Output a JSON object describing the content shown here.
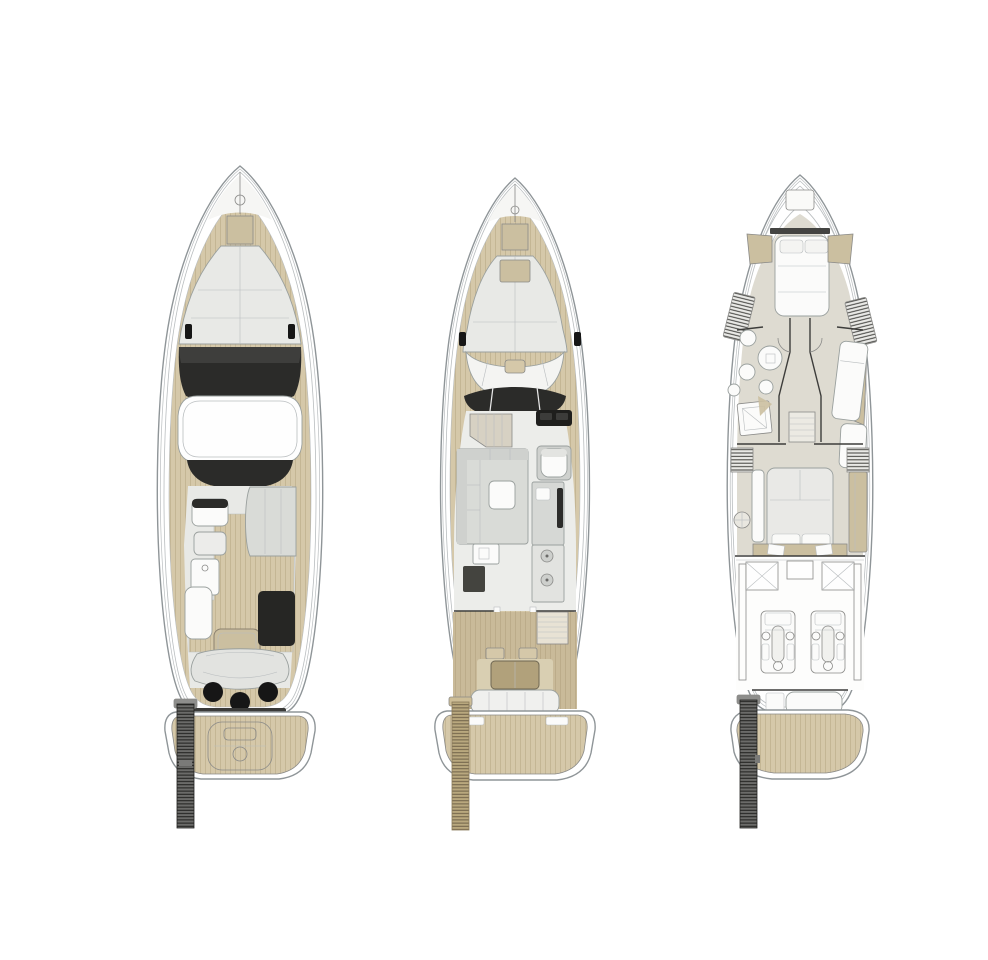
{
  "figure": {
    "type": "yacht-deck-plan-drawing",
    "views": 3
  },
  "colors": {
    "background": "#ffffff",
    "hull_white": "#ffffff",
    "hull_outline": "#8f9598",
    "hull_inner_line": "#b9bdbf",
    "teak": "#d5c8a9",
    "teak_dark": "#c9ba99",
    "plank_line": "#a4936f",
    "deck_gray": "#e8e9e6",
    "room_floor": "#dedbd1",
    "furniture_gray": "#d9dbd7",
    "furniture_gray2": "#cfd1ce",
    "furniture_edge": "#9aa09e",
    "white_fixture": "#fbfbfa",
    "beige": "#d7d1c3",
    "tan_accent": "#cbbfa0",
    "table_tan": "#b1a17b",
    "dark_glass": "#2b2b29",
    "dark_glass_light": "#4f4f4c",
    "black": "#161616",
    "wall_dark": "#3d3d3b",
    "sketch_line": "#8a8a88",
    "ladder_dark": "#6b6b69",
    "ladder_rung": "#1f1f1d",
    "ladder_tan": "#b9a87e",
    "ladder_tan_rung": "#6f6148",
    "slat_bg": "#e9e9e6",
    "slat_line": "#3f3f3c"
  },
  "plans": [
    {
      "id": "flybridge-deck",
      "features": [
        "anchor-locker",
        "bow-sunpad",
        "cleats",
        "windshield",
        "hardtop",
        "flybridge-windshield",
        "helm-seats",
        "helm-console",
        "flybridge-sofa",
        "flybridge-bench",
        "flybridge-table",
        "wet-bar-cabinet",
        "aft-sunbed",
        "bar-stools",
        "transom",
        "swim-platform",
        "tender",
        "passerelle-ladder"
      ]
    },
    {
      "id": "main-deck",
      "features": [
        "anchor-locker",
        "bow-sunpad",
        "bow-seating",
        "cleats",
        "windshield",
        "companionway",
        "helm-station",
        "helm-seat",
        "salon-sofa",
        "salon-table",
        "galley-counter",
        "galley-sink",
        "galley-burners",
        "cockpit-stairs",
        "cockpit-table",
        "aft-bench",
        "swim-platform",
        "passerelle-ladder"
      ]
    },
    {
      "id": "lower-deck",
      "features": [
        "bow-hatch",
        "vip-bed",
        "vip-shelves",
        "wardrobe-slats",
        "bathroom-sinks",
        "shower",
        "corridor",
        "staircase",
        "guest-berths",
        "master-bed",
        "master-wardrobe",
        "vent-boxes",
        "fuel-tanks",
        "engines",
        "crew-berth",
        "swim-platform",
        "passerelle-ladder"
      ]
    }
  ]
}
